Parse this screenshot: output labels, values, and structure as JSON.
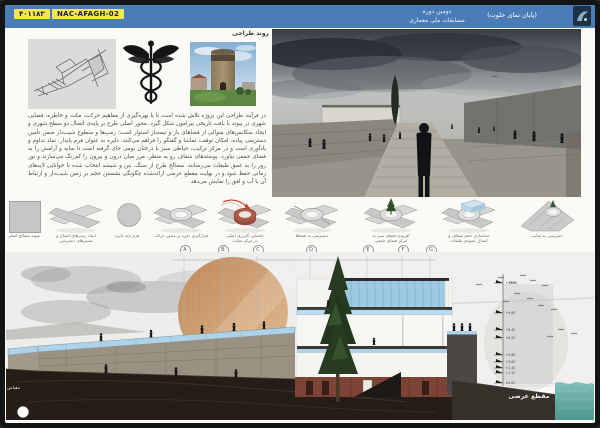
{
  "header": {
    "entry_code": "۴۰۱۱۸۳",
    "entry_id": "NAC-AFAGH-02",
    "event_line1": "دومین دوره",
    "event_line2": "مسابقات ملی معماری",
    "title": "(پایان نمای خلوت)"
  },
  "process": {
    "label": "روند طراحی",
    "images": [
      "concept-sketch",
      "caduceus-symbol",
      "historic-tower-photo",
      "perspective-render"
    ]
  },
  "description": {
    "text": "در فرآیند طراحی این پروژه تلاش شده است تا با بهره‌گیری از مفاهیم حرکت، مکث و خاطره، فضایی شهری در پیوند با بافت تاریخی پیرامون شکل گیرد. محور اصلی طرح بر پایه‌ی اتصال دو سطح شهری و ایجاد سکانس‌های متوالی از فضاهای باز و نیمه‌باز استوار است؛ رمپ‌ها و سطوح شیب‌دار ضمن تأمین دسترسی پیاده، امکان توقف، تماشا و گفتگو را فراهم می‌کنند. دایره به عنوان فرم پایدار، نماد تداوم و یادآوری است و در مرکز ترکیب، حیاطی سبز با درختان بومی جای گرفته است تا سایه و آرامش را به فضای جمعی بیاورد. پوسته‌های شفاف رو به منظر، مرز میان درون و بیرون را کم‌رنگ می‌سازند و نور روز را به عمق طبقات می‌رسانند. مصالح طرح از سنگ، بتن و شیشه انتخاب شده تا خوانایی لایه‌های زمانی حفظ شود و در نهایت مقطع عرضی ارائه‌شده چگونگی نشستن حجم بر زمین شیب‌دار و ارتباط آن با آب و افق را نمایش می‌دهد."
  },
  "diagrams": [
    "نمونه مصالح اصلی",
    "ایجاد رمپ‌های اتصال و\nمسیرهای دسترسی",
    "فرم پایه دایره",
    "قرارگیری دایره بر محور حرکت",
    "جانمایی کاربری اصلی\nدر مرکز سایت",
    "دسترسی به فضاها",
    "افزودن فضای سبز به\nمرکز فضای جمعی",
    "جداسازی حجم شفاف و\nاتصال عمودی طبقات",
    "دسترسی به سایت"
  ],
  "grid_letters": [
    "A",
    "B",
    "C",
    "D",
    "E",
    "F",
    "G"
  ],
  "section": {
    "scale_label": "مقیاس : ۱:۱۰۰",
    "label": "مقطع عرضی",
    "levels": [
      "+13.20",
      "+9.60",
      "+8.40",
      "+6.20",
      "+4.80",
      "+3.60",
      "+2.40",
      "+1.20",
      "±0.00"
    ]
  },
  "colors": {
    "frame": "#141414",
    "header_blue": "#4a7cb7",
    "highlight_yellow": "#f4e84e",
    "sun_tan": "#cf9a6e",
    "glass_blue": "#aed3e8",
    "rust_wall": "#7c4336",
    "earth": "#251e18",
    "water_teal": "#5fa69e"
  }
}
